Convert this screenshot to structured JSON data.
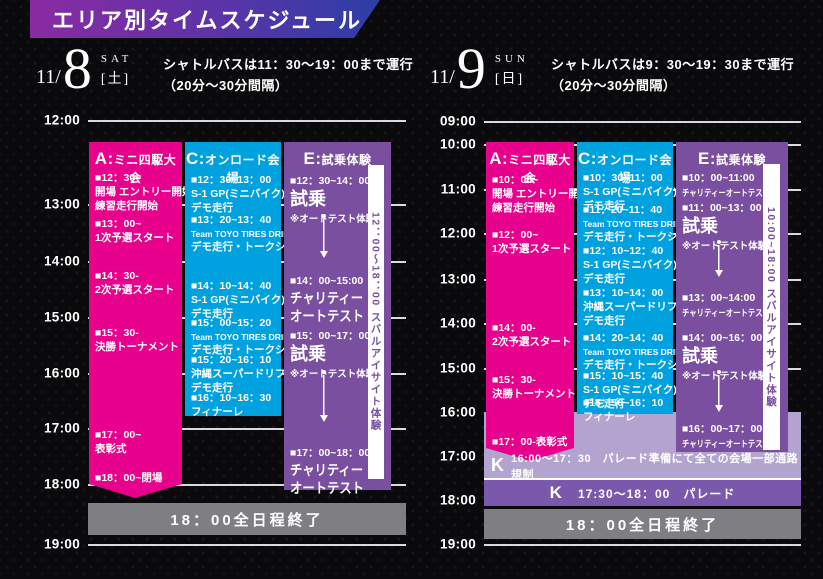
{
  "title": "エリア別タイムスケジュール",
  "colors": {
    "pink": "#e7018d",
    "cyan": "#00a1df",
    "purple": "#7b4fa0",
    "light_purple": "#b2a4ce",
    "dark_purple": "#7a58ac",
    "gray_bar": "#7f7f83",
    "banner_gradient_left": "#8b2aa2",
    "banner_gradient_right": "#2c3ea6"
  },
  "sat": {
    "date_prefix": "11/",
    "date_num": "8",
    "dow_en": "SAT",
    "dow_jp": "[土]",
    "shuttle_line1": "シャトルバスは11：30～19：00まで運行",
    "shuttle_line2": "（20分～30分間隔）",
    "hours": [
      "12:00",
      "13:00",
      "14:00",
      "15:00",
      "16:00",
      "17:00",
      "18:00",
      "19:00"
    ],
    "areaA": {
      "letter": "A:",
      "name": "ミニ四駆大会",
      "events": [
        {
          "time": "■12：30~",
          "desc": "開場 エントリー開始\n練習走行開始"
        },
        {
          "time": "■13：00~",
          "desc": "1次予選スタート"
        },
        {
          "time": "■14：30-",
          "desc": "2次予選スタート"
        },
        {
          "time": "■15：30-",
          "desc": "決勝トーナメント"
        },
        {
          "time": "■17：00~",
          "desc": "表彰式"
        },
        {
          "time": "■18：00~閉場",
          "desc": ""
        }
      ]
    },
    "areaC": {
      "letter": "C:",
      "name": "オンロード会場",
      "events": [
        {
          "time": "■12：30~13：00",
          "desc": "S-1 GP(ミニバイク)\nデモ走行"
        },
        {
          "time": "■13：20~13：40",
          "en": "Team TOYO TIRES DRIFT",
          "desc": "デモ走行・トークショー"
        },
        {
          "time": "■14：10~14：40",
          "desc": "S-1 GP(ミニバイク)\nデモ走行"
        },
        {
          "time": "■15：00~15：20",
          "en": "Team TOYO TIRES DRIFT",
          "desc": "デモ走行・トークショー"
        },
        {
          "time": "■15：20~16：10",
          "desc": "沖縄スーパードリフト\nデモ走行"
        },
        {
          "time": "■16：10~16：30",
          "desc": "フィナーレ"
        }
      ]
    },
    "areaE": {
      "letter": "E:",
      "name": "試乗体験",
      "events": [
        {
          "time": "■12：30~14：00",
          "big": "試乗",
          "note": "※オートテスト体験"
        },
        {
          "time": "■14：00~15:00",
          "med": "チャリティー\nオートテスト"
        },
        {
          "time": "■15：00~17：00",
          "big": "試乗",
          "note": "※オートテスト体験"
        },
        {
          "time": "■17：00~18：00",
          "med": "チャリティー\nオートテスト"
        }
      ],
      "side_label": "12：00～18：00 スバルアイサイト体験"
    },
    "footer": "18：00全日程終了"
  },
  "sun": {
    "date_prefix": "11/",
    "date_num": "9",
    "dow_en": "SUN",
    "dow_jp": "[日]",
    "shuttle_line1": "シャトルバスは9：30～19：30まで運行",
    "shuttle_line2": "（20分～30分間隔）",
    "hours": [
      "09:00",
      "10:00",
      "11:00",
      "12:00",
      "13:00",
      "14:00",
      "15:00",
      "16:00",
      "17:00",
      "18:00",
      "19:00"
    ],
    "areaA": {
      "letter": "A:",
      "name": "ミニ四駆大会",
      "events": [
        {
          "time": "■10：00~",
          "desc": "開場 エントリー開始\n練習走行開始"
        },
        {
          "time": "■12：00~",
          "desc": "1次予選スタート"
        },
        {
          "time": "■14：00-",
          "desc": "2次予選スタート"
        },
        {
          "time": "■15：30-",
          "desc": "決勝トーナメント"
        },
        {
          "time": "■17：00-表彰式",
          "desc": ""
        }
      ]
    },
    "areaC": {
      "letter": "C:",
      "name": "オンロード会場",
      "events": [
        {
          "time": "■10：30~11：00",
          "desc": "S-1 GP(ミニバイク)\nデモ走行"
        },
        {
          "time": "■11：20~11：40",
          "en": "Team TOYO TIRES DRIFT",
          "desc": "デモ走行・トークショー"
        },
        {
          "time": "■12：10~12：40",
          "desc": "S-1 GP(ミニバイク)\nデモ走行"
        },
        {
          "time": "■13：10~14：00",
          "desc": "沖縄スーパードリフト\nデモ走行"
        },
        {
          "time": "■14：20~14：40",
          "en": "Team TOYO TIRES DRIFT",
          "desc": "デモ走行・トークショー"
        },
        {
          "time": "■15：10~15：40",
          "desc": "S-1 GP(ミニバイク)\nデモ走行"
        },
        {
          "time": "■15：50~16：10",
          "desc": "フィナーレ"
        }
      ]
    },
    "areaE": {
      "letter": "E:",
      "name": "試乗体験",
      "events": [
        {
          "time": "■10：00~11:00",
          "small": "チャリティーオートテスト"
        },
        {
          "time": "■11：00~13：00",
          "big": "試乗",
          "note": "※オートテスト体験"
        },
        {
          "time": "■13：00~14:00",
          "small": "チャリティーオートテスト"
        },
        {
          "time": "■14：00~16：00",
          "big": "試乗",
          "note": "※オートテスト体験"
        },
        {
          "time": "■16：00~17：00",
          "small": "チャリティーオートテスト"
        }
      ],
      "side_label": "10:00~18:00 スバルアイサイト体験"
    },
    "k_notice": {
      "letter": "K",
      "text": "16:00～17：30　パレード準備にて全ての会場一部通路規制"
    },
    "k_parade": {
      "letter": "K",
      "text": "17:30～18：00　パレード"
    },
    "footer": "18：00全日程終了"
  }
}
